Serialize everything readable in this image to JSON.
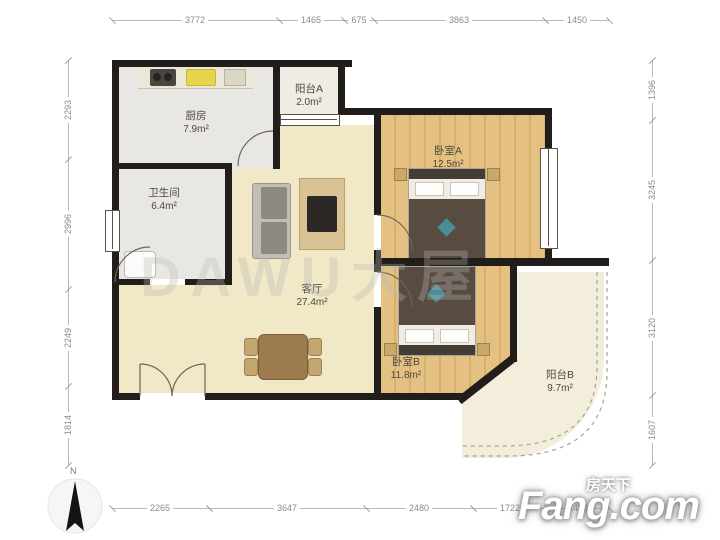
{
  "rooms": {
    "kitchen": {
      "name": "厨房",
      "area": "7.9m²"
    },
    "balcony_a": {
      "name": "阳台A",
      "area": "2.0m²"
    },
    "bedroom_a": {
      "name": "卧室A",
      "area": "12.5m²"
    },
    "bathroom": {
      "name": "卫生间",
      "area": "6.4m²"
    },
    "living": {
      "name": "客厅",
      "area": "27.4m²"
    },
    "bedroom_b": {
      "name": "卧室B",
      "area": "11.8m²"
    },
    "balcony_b": {
      "name": "阳台B",
      "area": "9.7m²"
    }
  },
  "dimensions": {
    "top": [
      "3772",
      "1465",
      "675",
      "3863",
      "1450"
    ],
    "bottom": [
      "2265",
      "3647",
      "2480",
      "1722",
      "1450"
    ],
    "left": [
      "2293",
      "2996",
      "2249",
      "1814"
    ],
    "right": [
      "1396",
      "3245",
      "3120",
      "1607"
    ]
  },
  "watermark": "DAWU大屋",
  "compass": {
    "label": "N"
  },
  "logo": {
    "cn": "房天下",
    "en": "Fang.com"
  },
  "colors": {
    "wall": "#211d1a",
    "living_floor": "#f0e8c6",
    "wood_floor": "#e2bd7e",
    "tile_floor": "#e9e7e3",
    "balcony_floor": "#f3eedb",
    "duvet": "#584c40",
    "accent_teal": "#4a8d96"
  }
}
